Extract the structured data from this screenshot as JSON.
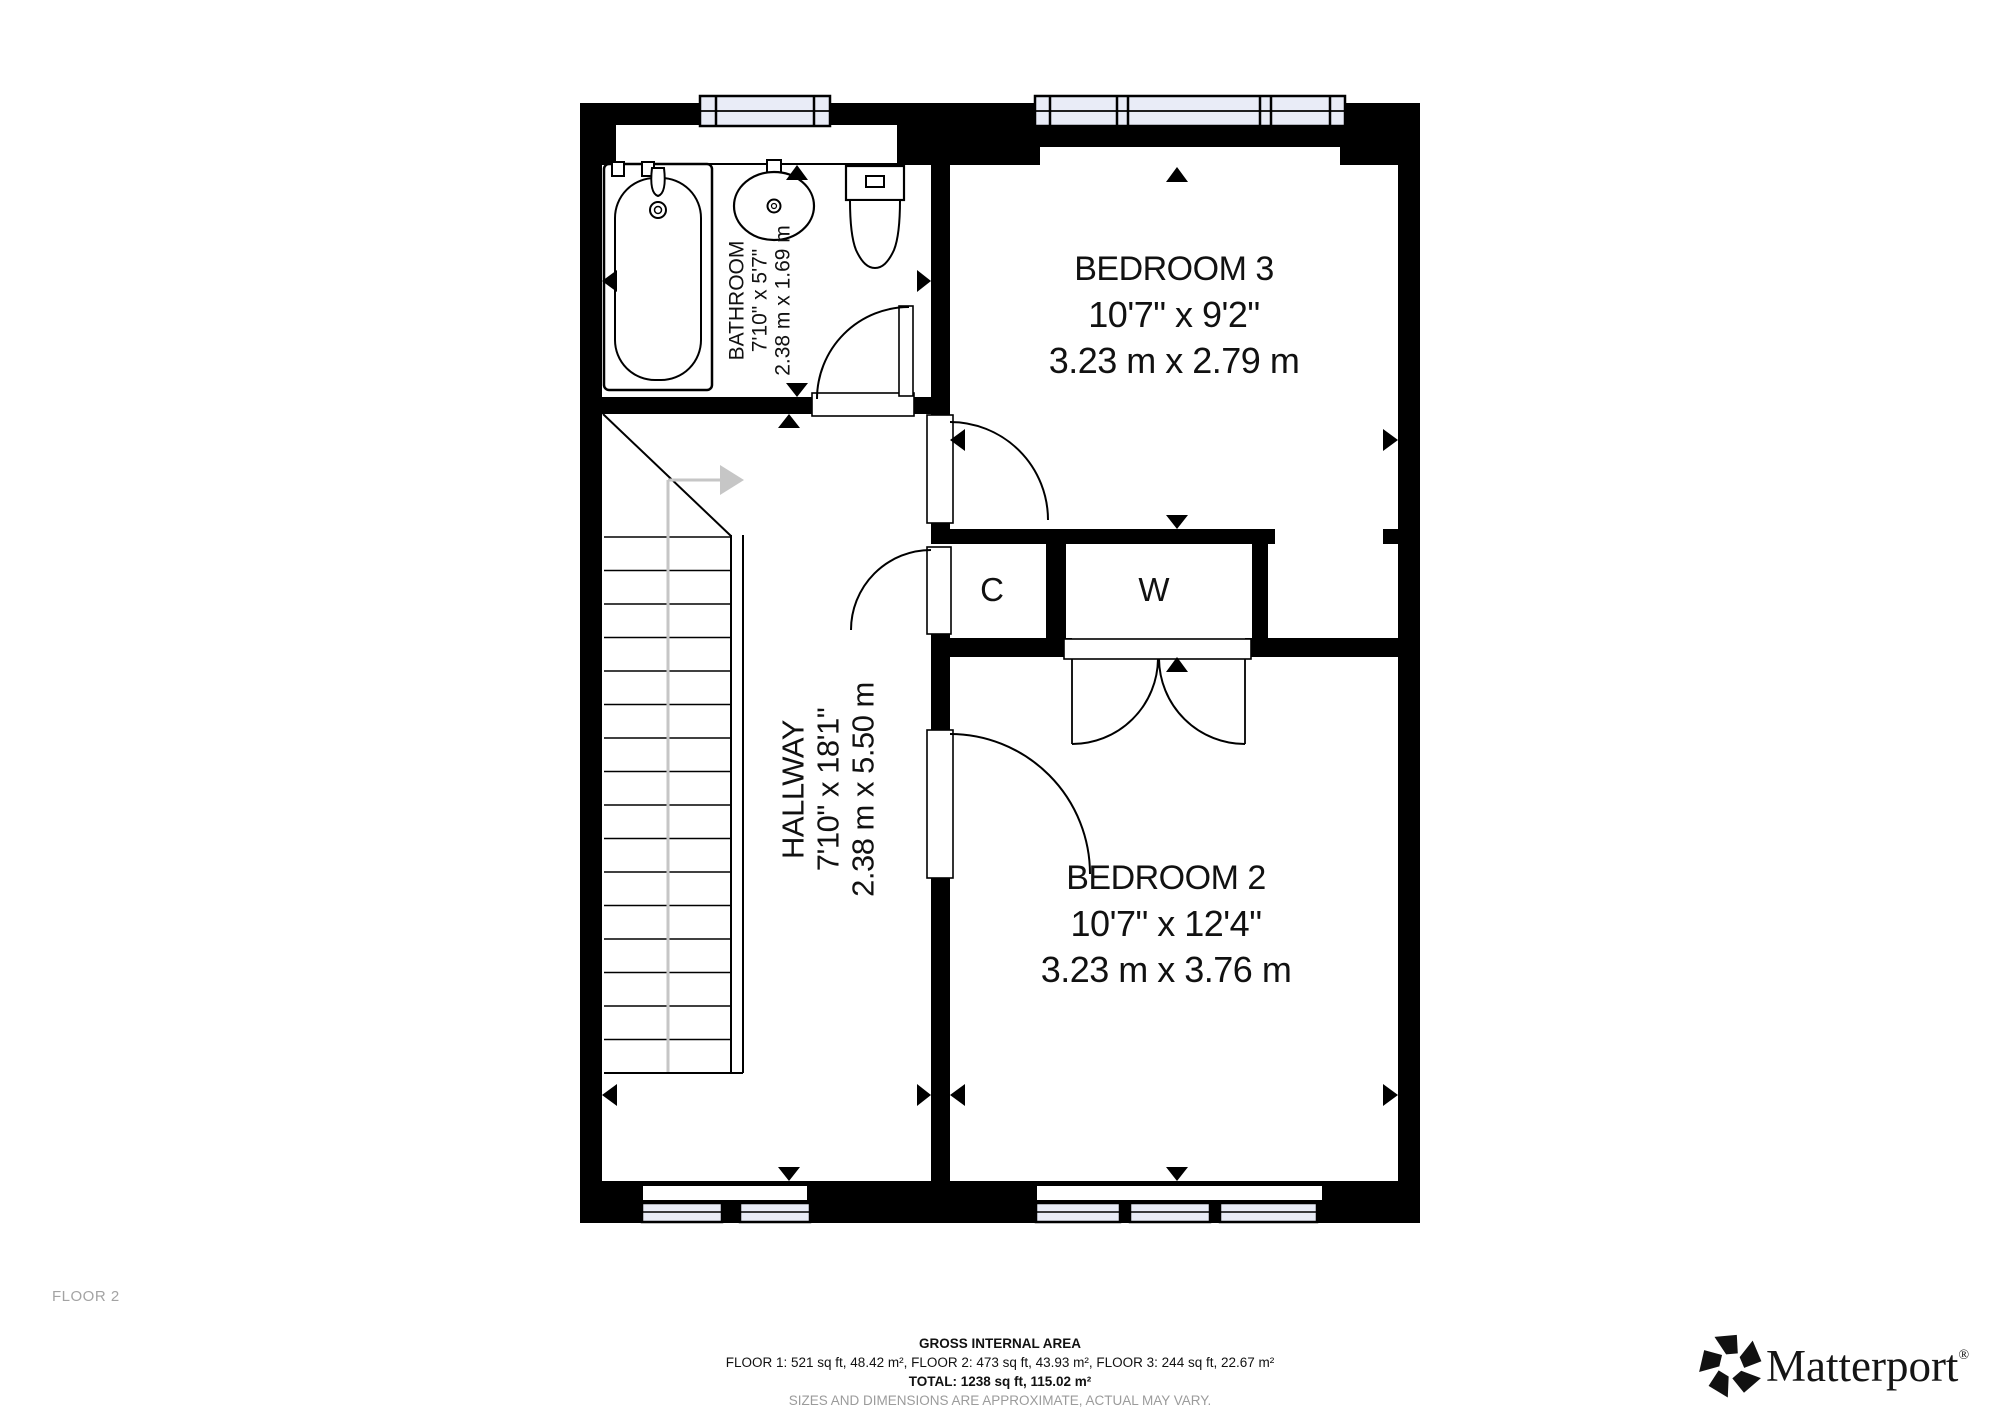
{
  "plan": {
    "rooms": {
      "bathroom": {
        "name": "BATHROOM",
        "imperial": "7'10\" x 5'7\"",
        "metric": "2.38 m x 1.69 m"
      },
      "bedroom3": {
        "name": "BEDROOM 3",
        "imperial": "10'7\" x 9'2\"",
        "metric": "3.23 m x 2.79 m"
      },
      "hallway": {
        "name": "HALLWAY",
        "imperial": "7'10\" x 18'1\"",
        "metric": "2.38 m x 5.50 m"
      },
      "bedroom2": {
        "name": "BEDROOM 2",
        "imperial": "10'7\" x 12'4\"",
        "metric": "3.23 m x 3.76 m"
      },
      "closet_c": {
        "name": "C"
      },
      "closet_w": {
        "name": "W"
      }
    },
    "icons": {
      "stair_direction_arrow": "right-arrow",
      "dimension_markers": "black-triangles"
    },
    "colors": {
      "wall": "#000000",
      "window_fill": "#e9ecf7",
      "stair_guide": "#c6c6c6",
      "muted_text": "#9b9b9b"
    }
  },
  "footer": {
    "floor_label": "FLOOR 2",
    "title": "GROSS INTERNAL AREA",
    "areas_line": "FLOOR 1: 521 sq ft, 48.42 m², FLOOR 2: 473 sq ft, 43.93 m², FLOOR 3: 244 sq ft, 22.67 m²",
    "total_line": "TOTAL: 1238 sq ft, 115.02 m²",
    "disclaimer": "SIZES AND DIMENSIONS ARE APPROXIMATE, ACTUAL MAY VARY."
  },
  "brand": {
    "name": "Matterport",
    "registered": "®"
  }
}
